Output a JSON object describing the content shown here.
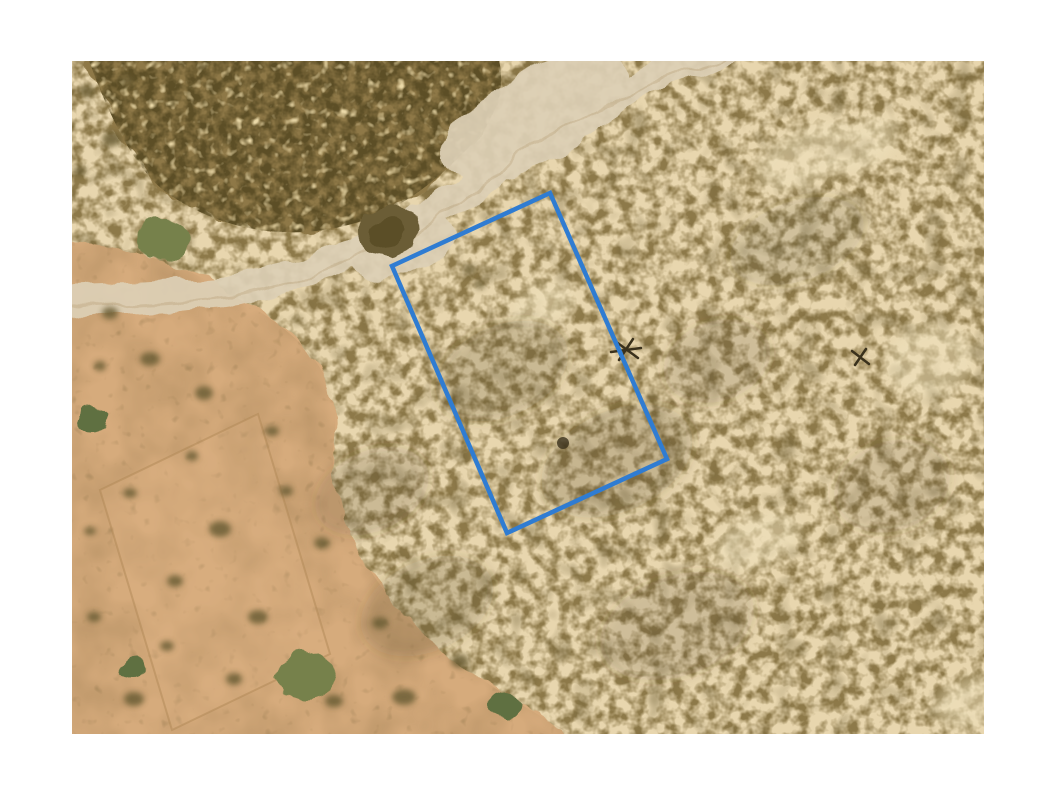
{
  "page": {
    "background_color": "#ffffff"
  },
  "satellite_image": {
    "left_px": 72,
    "top_px": 61,
    "width_px": 912,
    "height_px": 673,
    "description": "Aerial satellite view of semi-arid scrubland: dense olive-brown brush over cream sand, a pale dirt road crossing diagonally from the top edge to the left edge, an open orange-tan field with a faint cleared plot in the lower left, scattered green shrubs, and a blue surveyed parcel boundary rectangle in the center"
  },
  "palette": {
    "sand_base": "#e8d6ae",
    "scrub_blob": "#8d7949",
    "scrub_shadow": "#6b5c33",
    "mass_fill": "#8e7847",
    "mass_dark": "#5c4e26",
    "mass_hole": "#ebd9a8",
    "field_tan": "#d6ab7c",
    "field_smudge": "#9a7b50",
    "road_light": "#ddd0b6",
    "road_track": "#c9b795",
    "bush_dark": "#6b5d36",
    "shrub_green": "#76814b",
    "shrub_green_dark": "#5f7041",
    "plot_line": "#b08756",
    "plot_fill": "#ddb386",
    "dead_tree": "#3a311c",
    "shadow": "#4a3f24",
    "cream_patch": "#f0e3bf"
  },
  "parcel_overlay": {
    "shape": "rotated-rectangle",
    "points": "478,132 320,205 435,472 595,398",
    "stroke_color": "#2f7cd2",
    "stroke_width": 4.5,
    "fill": "none"
  }
}
